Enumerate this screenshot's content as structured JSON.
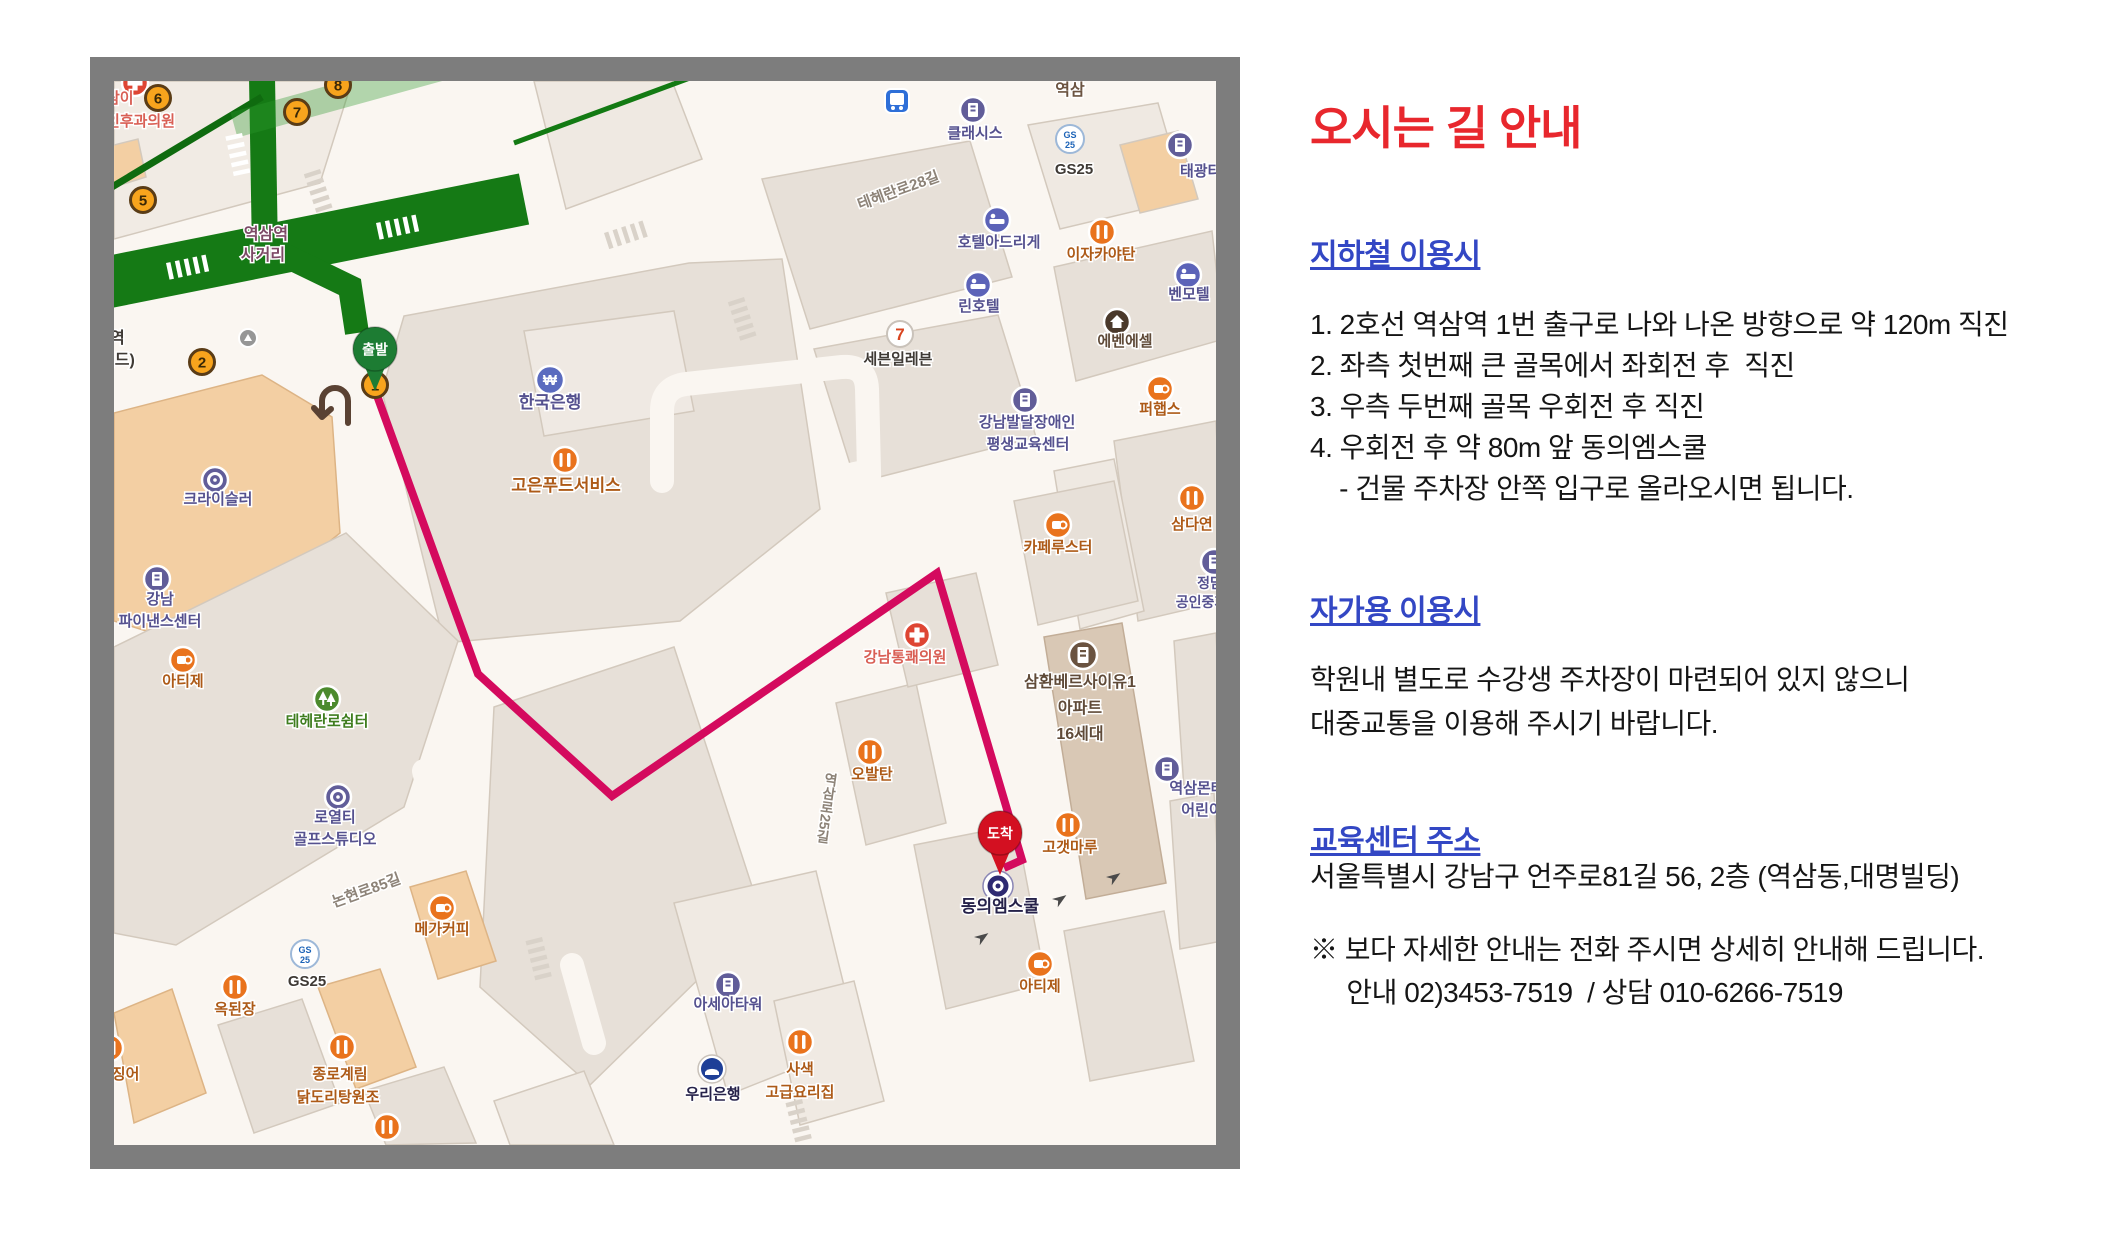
{
  "panel": {
    "title": "오시는 길 안내",
    "sections": [
      {
        "heading": "지하철 이용시",
        "lines": [
          "1. 2호선 역삼역 1번 출구로 나와 나온 방향으로 약 120m 직진",
          "2. 좌측 첫번째 큰 골목에서 좌회전 후  직진",
          "3. 우측 두번째 골목 우회전 후 직진",
          "4. 우회전 후 약 80m 앞 동의엠스쿨",
          "    - 건물 주차장 안쪽 입구로 올라오시면 됩니다."
        ]
      },
      {
        "heading": "자가용 이용시",
        "lines": [
          "학원내 별도로 수강생 주차장이 마련되어 있지 않으니",
          "대중교통을 이용해 주시기 바랍니다."
        ]
      },
      {
        "heading": "교육센터 주소",
        "lines": [
          "서울특별시 강남구 언주로81길 56, 2층 (역삼동,대명빌딩)"
        ]
      }
    ],
    "notes": [
      "※ 보다 자세한 안내는 전화 주시면 상세히 안내해 드립니다.",
      "     안내 02)3453-7519  / 상담 010-6266-7519"
    ]
  },
  "map": {
    "frame_color": "#7d7d7d",
    "route_color": "#d40a5e",
    "route_points": "261,309 364,593 498,715 823,492 908,779 890,787",
    "start_pin": {
      "label": "출발",
      "x": 261,
      "y": 268,
      "color": "#1d7c33"
    },
    "dest_pin": {
      "label": "도착",
      "x": 886,
      "y": 752,
      "color": "#d31021"
    },
    "exits": [
      {
        "n": "6",
        "x": 44,
        "y": 17
      },
      {
        "n": "7",
        "x": 183,
        "y": 31
      },
      {
        "n": "8",
        "x": 224,
        "y": 4
      },
      {
        "n": "5",
        "x": 29,
        "y": 119
      },
      {
        "n": "2",
        "x": 88,
        "y": 281
      },
      {
        "n": "1",
        "x": 261,
        "y": 304
      }
    ],
    "colors": {
      "navy": "#55518f",
      "orange2": "#ad5a17",
      "dark": "#3f3a35",
      "plum": "#7d4a66",
      "red2": "#d95f55",
      "green2": "#3f7d1f",
      "road": "#8d8378",
      "brown2": "#6b5340",
      "brown3": "#5f4a38",
      "ink": "#26224a"
    },
    "labels": [
      {
        "t": "삼이",
        "x": -8,
        "y": 22,
        "c": "red2",
        "s": 15,
        "a": "start"
      },
      {
        "t": "인후과의원",
        "x": -8,
        "y": 45,
        "c": "red2",
        "s": 15,
        "a": "start"
      },
      {
        "t": "역삼역",
        "x": 152,
        "y": 158,
        "c": "plum",
        "s": 16
      },
      {
        "t": "사거리",
        "x": 149,
        "y": 179,
        "c": "plum",
        "s": 16
      },
      {
        "t": "역",
        "x": -4,
        "y": 262,
        "c": "dark",
        "s": 16,
        "a": "start"
      },
      {
        "t": "빌드)",
        "x": -14,
        "y": 284,
        "c": "dark",
        "s": 16,
        "a": "start"
      },
      {
        "t": "한국은행",
        "x": 436,
        "y": 327,
        "c": "navy",
        "s": 17
      },
      {
        "t": "고은푸드서비스",
        "x": 452,
        "y": 410,
        "c": "orange2",
        "s": 17
      },
      {
        "t": "역삼",
        "x": 956,
        "y": 14,
        "c": "brown2",
        "s": 16
      },
      {
        "t": "클래시스",
        "x": 861,
        "y": 57,
        "c": "navy",
        "s": 15
      },
      {
        "t": "GS25",
        "x": 960,
        "y": 93,
        "c": "dark",
        "s": 15
      },
      {
        "t": "태광타워",
        "x": 1066,
        "y": 95,
        "c": "navy",
        "s": 15,
        "a": "start"
      },
      {
        "t": "테헤란로28길",
        "x": 786,
        "y": 114,
        "c": "road",
        "s": 15,
        "r": -20
      },
      {
        "t": "호텔아드리게",
        "x": 885,
        "y": 166,
        "c": "navy",
        "s": 15
      },
      {
        "t": "이자카야탄",
        "x": 987,
        "y": 178,
        "c": "orange2",
        "s": 15
      },
      {
        "t": "린호텔",
        "x": 865,
        "y": 230,
        "c": "navy",
        "s": 15
      },
      {
        "t": "벤모텔",
        "x": 1075,
        "y": 218,
        "c": "navy",
        "s": 15
      },
      {
        "t": "에벤에셀",
        "x": 1011,
        "y": 265,
        "c": "brown3",
        "s": 15
      },
      {
        "t": "세븐일레븐",
        "x": 784,
        "y": 283,
        "c": "dark",
        "s": 15
      },
      {
        "t": "퍼햅스",
        "x": 1046,
        "y": 333,
        "c": "orange2",
        "s": 15
      },
      {
        "t": "강남발달장애인",
        "x": 913,
        "y": 346,
        "c": "navy",
        "s": 15
      },
      {
        "t": "평생교육센터",
        "x": 914,
        "y": 368,
        "c": "navy",
        "s": 15
      },
      {
        "t": "카페루스터",
        "x": 944,
        "y": 471,
        "c": "orange2",
        "s": 15
      },
      {
        "t": "삼다연",
        "x": 1078,
        "y": 448,
        "c": "orange2",
        "s": 15
      },
      {
        "t": "정담",
        "x": 1096,
        "y": 507,
        "c": "navy",
        "s": 14
      },
      {
        "t": "공인중개사",
        "x": 1094,
        "y": 526,
        "c": "navy",
        "s": 14
      },
      {
        "t": "삼환베르사이유1",
        "x": 966,
        "y": 606,
        "c": "brown3",
        "s": 16
      },
      {
        "t": "아파트",
        "x": 966,
        "y": 632,
        "c": "brown3",
        "s": 16
      },
      {
        "t": "16세대",
        "x": 966,
        "y": 658,
        "c": "brown3",
        "s": 16
      },
      {
        "t": "강남통쾌의원",
        "x": 791,
        "y": 581,
        "c": "red2",
        "s": 15
      },
      {
        "t": "오발탄",
        "x": 758,
        "y": 698,
        "c": "orange2",
        "s": 15
      },
      {
        "t": "역삼로25길",
        "x": 713,
        "y": 727,
        "c": "road",
        "s": 14,
        "vert": true
      },
      {
        "t": "역삼몬테",
        "x": 1083,
        "y": 712,
        "c": "navy",
        "s": 15
      },
      {
        "t": "어린이",
        "x": 1088,
        "y": 734,
        "c": "navy",
        "s": 15
      },
      {
        "t": "고갯마루",
        "x": 956,
        "y": 771,
        "c": "orange2",
        "s": 15
      },
      {
        "t": "동의엠스쿨",
        "x": 886,
        "y": 831,
        "c": "ink",
        "s": 17
      },
      {
        "t": "아티제",
        "x": 926,
        "y": 910,
        "c": "orange2",
        "s": 15
      },
      {
        "t": "사색",
        "x": 686,
        "y": 993,
        "c": "orange2",
        "s": 15
      },
      {
        "t": "고급요리집",
        "x": 686,
        "y": 1016,
        "c": "orange2",
        "s": 15
      },
      {
        "t": "크라이슬러",
        "x": 104,
        "y": 423,
        "c": "navy",
        "s": 15
      },
      {
        "t": "강남",
        "x": 46,
        "y": 523,
        "c": "navy",
        "s": 15
      },
      {
        "t": "파이낸스센터",
        "x": 46,
        "y": 545,
        "c": "navy",
        "s": 15
      },
      {
        "t": "아티제",
        "x": 69,
        "y": 605,
        "c": "orange2",
        "s": 15
      },
      {
        "t": "테헤란로쉼터",
        "x": 213,
        "y": 645,
        "c": "green2",
        "s": 15
      },
      {
        "t": "로열티",
        "x": 221,
        "y": 741,
        "c": "navy",
        "s": 15
      },
      {
        "t": "골프스튜디오",
        "x": 221,
        "y": 763,
        "c": "navy",
        "s": 15
      },
      {
        "t": "논현로85길",
        "x": 254,
        "y": 814,
        "c": "road",
        "s": 15,
        "r": -20
      },
      {
        "t": "메가커피",
        "x": 328,
        "y": 853,
        "c": "orange2",
        "s": 15
      },
      {
        "t": "GS25",
        "x": 193,
        "y": 905,
        "c": "dark",
        "s": 15
      },
      {
        "t": "옥된장",
        "x": 121,
        "y": 933,
        "c": "orange2",
        "s": 15
      },
      {
        "t": "오징어",
        "x": -16,
        "y": 998,
        "c": "orange2",
        "s": 15,
        "a": "start"
      },
      {
        "t": "종로계림",
        "x": 226,
        "y": 998,
        "c": "orange2",
        "s": 15
      },
      {
        "t": "닭도리탕원조",
        "x": 224,
        "y": 1021,
        "c": "orange2",
        "s": 15
      },
      {
        "t": "아세아타워",
        "x": 614,
        "y": 928,
        "c": "navy",
        "s": 15
      },
      {
        "t": "우리은행",
        "x": 599,
        "y": 1018,
        "c": "ink",
        "s": 15
      }
    ],
    "pois": [
      {
        "type": "cross",
        "x": 21,
        "y": 2
      },
      {
        "type": "bankW",
        "x": 436,
        "y": 299
      },
      {
        "type": "rest",
        "x": 451,
        "y": 379
      },
      {
        "type": "bldg",
        "x": 859,
        "y": 29
      },
      {
        "type": "gs25",
        "x": 956,
        "y": 58
      },
      {
        "type": "bldg",
        "x": 1066,
        "y": 64
      },
      {
        "type": "bus",
        "x": 783,
        "y": 20
      },
      {
        "type": "hotel",
        "x": 883,
        "y": 139
      },
      {
        "type": "rest",
        "x": 988,
        "y": 151
      },
      {
        "type": "hotel",
        "x": 864,
        "y": 204
      },
      {
        "type": "hotel",
        "x": 1074,
        "y": 194
      },
      {
        "type": "houseDark",
        "x": 1003,
        "y": 241
      },
      {
        "type": "seven",
        "x": 786,
        "y": 253
      },
      {
        "type": "cafe",
        "x": 1046,
        "y": 308
      },
      {
        "type": "bldg",
        "x": 911,
        "y": 319
      },
      {
        "type": "cafe",
        "x": 944,
        "y": 444
      },
      {
        "type": "rest",
        "x": 1078,
        "y": 417
      },
      {
        "type": "bldg",
        "x": 1100,
        "y": 481
      },
      {
        "type": "apt",
        "x": 969,
        "y": 574
      },
      {
        "type": "cross",
        "x": 803,
        "y": 554
      },
      {
        "type": "rest",
        "x": 756,
        "y": 671
      },
      {
        "type": "bldg",
        "x": 1053,
        "y": 688
      },
      {
        "type": "rest",
        "x": 954,
        "y": 744
      },
      {
        "type": "cafe",
        "x": 926,
        "y": 883
      },
      {
        "type": "rest",
        "x": 686,
        "y": 961
      },
      {
        "type": "ring",
        "x": 101,
        "y": 399
      },
      {
        "type": "bldg",
        "x": 43,
        "y": 498
      },
      {
        "type": "cafe",
        "x": 69,
        "y": 579
      },
      {
        "type": "park",
        "x": 213,
        "y": 618
      },
      {
        "type": "ring",
        "x": 224,
        "y": 716
      },
      {
        "type": "cafe",
        "x": 328,
        "y": 827
      },
      {
        "type": "gs25",
        "x": 191,
        "y": 873
      },
      {
        "type": "rest",
        "x": 121,
        "y": 906
      },
      {
        "type": "rest",
        "x": -4,
        "y": 967
      },
      {
        "type": "rest",
        "x": 228,
        "y": 966
      },
      {
        "type": "rest",
        "x": 273,
        "y": 1046
      },
      {
        "type": "bldg",
        "x": 614,
        "y": 904
      },
      {
        "type": "woori",
        "x": 598,
        "y": 988
      },
      {
        "type": "grayc",
        "x": 134,
        "y": 257
      },
      {
        "type": "target",
        "x": 884,
        "y": 805
      }
    ]
  }
}
